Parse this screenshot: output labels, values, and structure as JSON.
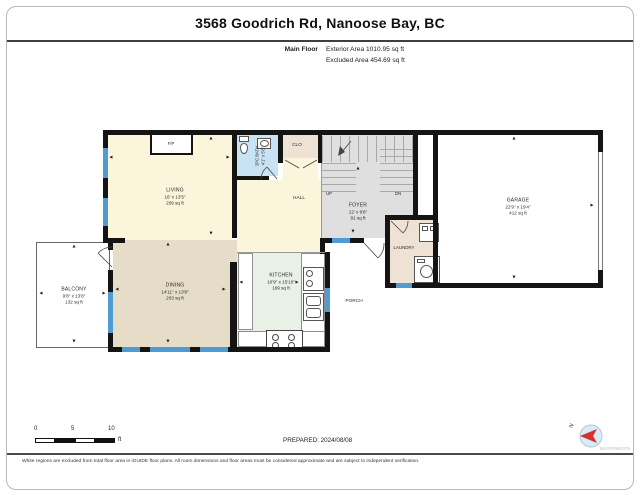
{
  "header": {
    "title": "3568 Goodrich Rd, Nanoose Bay, BC",
    "floor_label": "Main Floor",
    "exterior_area": "Exterior Area 1010.95 sq ft",
    "excluded_area": "Excluded Area 454.69 sq ft"
  },
  "rooms": {
    "living": {
      "name": "LIVING",
      "dims": "16' x 13'5\"",
      "area": "209 sq ft"
    },
    "dining": {
      "name": "DINING",
      "dims": "14'11\" x 13'8\"",
      "area": "203 sq ft"
    },
    "kitchen": {
      "name": "KITCHEN",
      "dims": "10'9\" x 15'10\"",
      "area": "169 sq ft"
    },
    "foyer": {
      "name": "FOYER",
      "dims": "12' x 9'8\"",
      "area": "91 sq ft"
    },
    "garage": {
      "name": "GARAGE",
      "dims": "22'9\" x 19'4\"",
      "area": "412 sq ft"
    },
    "balcony": {
      "name": "BALCONY",
      "dims": "9'8\" x 13'8\"",
      "area": "132 sq ft"
    },
    "bath": {
      "name": "2PC BATH",
      "dims": "4'1\" x 5'8\""
    },
    "hall": {
      "name": "HALL"
    },
    "closet": {
      "name": "CLO"
    },
    "laundry": {
      "name": "LAUNDRY"
    },
    "porch": {
      "name": "PORCH"
    },
    "fireplace": {
      "name": "F/P"
    },
    "stairs_up": {
      "name": "UP"
    },
    "stairs_down": {
      "name": "DN"
    }
  },
  "icons": {
    "up": "▲",
    "down": "▼",
    "left": "◄",
    "right": "►",
    "north": "N"
  },
  "scale_bar": {
    "ticks": [
      "0",
      "5",
      "10"
    ],
    "unit": "ft"
  },
  "footer": {
    "prepared": "PREPARED: 2024/08/08",
    "mls": "MLS®#964376",
    "disclaimer": "White regions are excluded from total floor area in iGUIDE floor plans. All room dimensions and floor areas must be considered approximate and are subject to independent verification."
  },
  "colors": {
    "wall": "#141414",
    "window": "#4e9cd2",
    "living_fill": "#fbf5dc",
    "dining_fill": "#e6ddc8",
    "kitchen_fill": "#e9f0e6",
    "bath_fill": "#c8e3f4",
    "closet_fill": "#ede2d4",
    "stair_fill": "#dfdfdf",
    "compass_red": "#d2342b",
    "compass_blue": "#d8ebf7"
  }
}
